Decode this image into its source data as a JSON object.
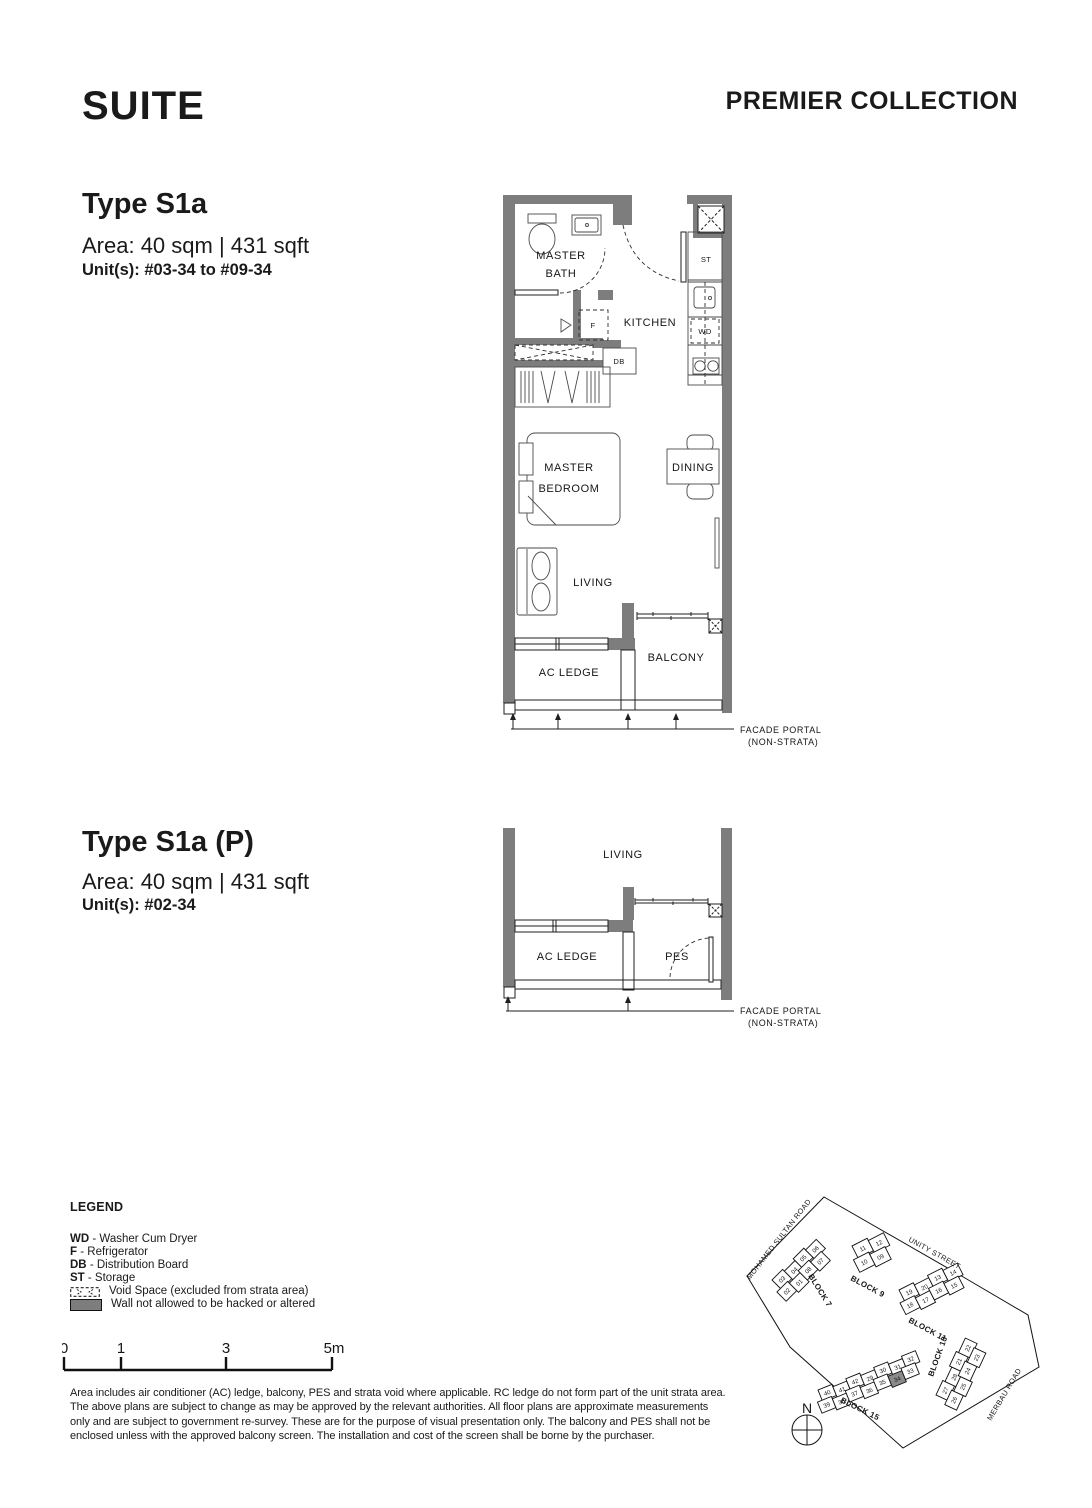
{
  "header": {
    "title": "SUITE",
    "collection": "PREMIER COLLECTION"
  },
  "plan1": {
    "type": "Type S1a",
    "area": "Area: 40 sqm | 431 sqft",
    "units": "Unit(s): #03-34 to #09-34",
    "labels": {
      "master_bath_1": "MASTER",
      "master_bath_2": "BATH",
      "kitchen": "KITCHEN",
      "st": "ST",
      "wd": "WD",
      "f": "F",
      "db": "DB",
      "bedroom_1": "MASTER",
      "bedroom_2": "BEDROOM",
      "dining": "DINING",
      "living": "LIVING",
      "balcony": "BALCONY",
      "ac_ledge": "AC LEDGE",
      "facade_1": "FACADE PORTAL",
      "facade_2": "(NON-STRATA)"
    }
  },
  "plan2": {
    "type": "Type S1a (P)",
    "area": "Area: 40 sqm | 431 sqft",
    "units": "Unit(s): #02-34",
    "labels": {
      "living": "LIVING",
      "ac_ledge": "AC LEDGE",
      "pes": "PES",
      "facade_1": "FACADE PORTAL",
      "facade_2": "(NON-STRATA)"
    }
  },
  "legend": {
    "title": "LEGEND",
    "items": [
      {
        "abbr": "WD",
        "desc": "- Washer Cum Dryer"
      },
      {
        "abbr": "F",
        "desc": "- Refrigerator"
      },
      {
        "abbr": "DB",
        "desc": "- Distribution Board"
      },
      {
        "abbr": "ST",
        "desc": "- Storage"
      }
    ],
    "void_label": "Void Space (excluded from strata area)",
    "wall_label": "Wall not allowed to be hacked or altered"
  },
  "scalebar": {
    "ticks": [
      "0",
      "1",
      "3",
      "5m"
    ]
  },
  "disclaimer": "Area includes air conditioner (AC) ledge, balcony, PES and strata void where applicable. RC ledge do not form part of the unit strata area. The above plans are subject to change as may be approved by the relevant authorities. All floor plans are approximate measurements only and are subject to government re-survey. These are for the purpose of visual presentation only. The balcony and PES shall not be enclosed unless with the approved balcony screen. The installation and cost of the screen shall be borne by the purchaser.",
  "siteplan": {
    "roads": {
      "mohamed_sultan": "MOHAMED SULTAN ROAD",
      "unity": "UNITY STREET",
      "merbau": "MERBAU ROAD"
    },
    "north": "N",
    "highlight_unit": "34",
    "blocks": [
      {
        "name": "BLOCK 7",
        "row1": [
          "03",
          "04",
          "05",
          "06"
        ],
        "row2": [
          "02",
          "01",
          "08",
          "07"
        ]
      },
      {
        "name": "BLOCK 9",
        "row1": [
          "11",
          "12"
        ],
        "row2": [
          "10",
          "09"
        ]
      },
      {
        "name": "BLOCK 11",
        "row1": [
          "19",
          "20",
          "13",
          "14"
        ],
        "row2": [
          "18",
          "17",
          "16",
          "15"
        ]
      },
      {
        "name": "BLOCK 13",
        "row1": [
          "27",
          "28",
          "21",
          "22"
        ],
        "row2": [
          "26",
          "25",
          "24",
          "23"
        ]
      },
      {
        "name": "BLOCK 15",
        "row1": [
          "40",
          "41",
          "42",
          "29",
          "30",
          "31",
          "32"
        ],
        "row2": [
          "39",
          "38",
          "37",
          "36",
          "35",
          "34",
          "33"
        ]
      }
    ]
  }
}
